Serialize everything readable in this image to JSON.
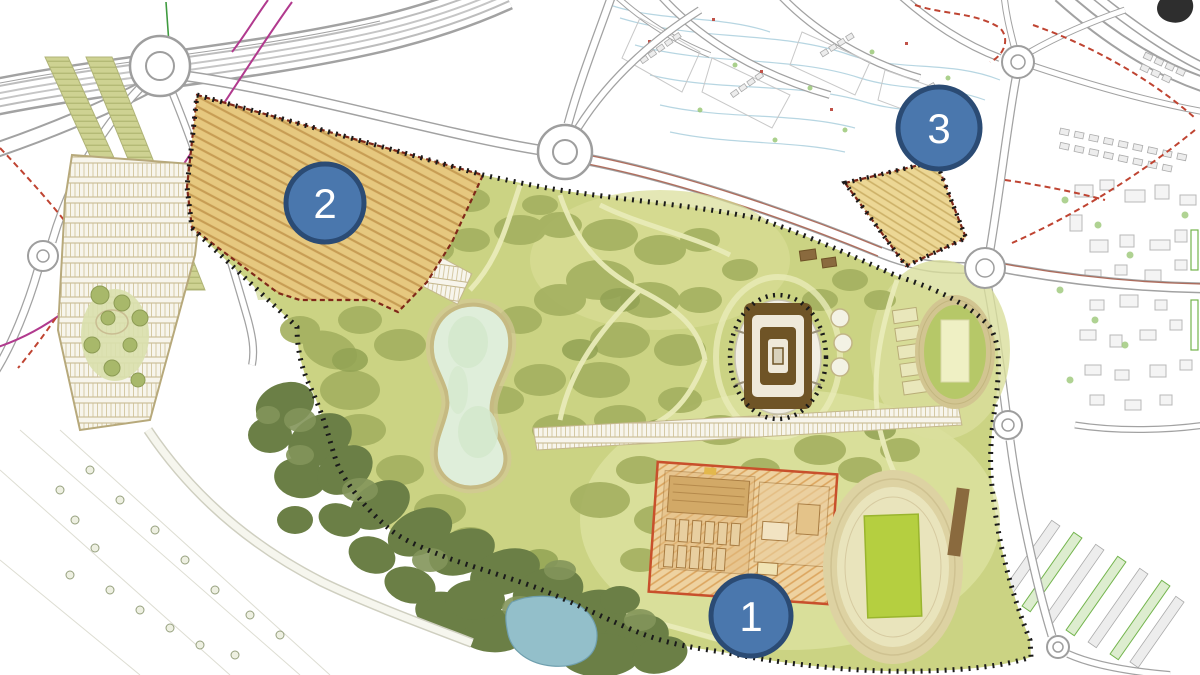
{
  "map": {
    "kind": "urban-park-master-plan",
    "markers": [
      {
        "label": "1"
      },
      {
        "label": "2"
      },
      {
        "label": "3"
      }
    ],
    "colors": {
      "marker_fill": "#4a77ad",
      "marker_border": "#2b4b74",
      "marker_text": "#ffffff",
      "park_green": "#cbd383",
      "tree_olive": "#a5b161",
      "forest_dark": "#6b7f46",
      "lake": "#dfeeda",
      "pond": "#93bfca",
      "development_hatch_tan": "#e6c87f",
      "zone1_border_red": "#c8502c",
      "stadium_brown": "#6f5426",
      "boundary_dotted_black": "#1a1a1a",
      "red_dashed_line": "#bf4432",
      "magenta_utility_line": "#b13a8e"
    }
  }
}
